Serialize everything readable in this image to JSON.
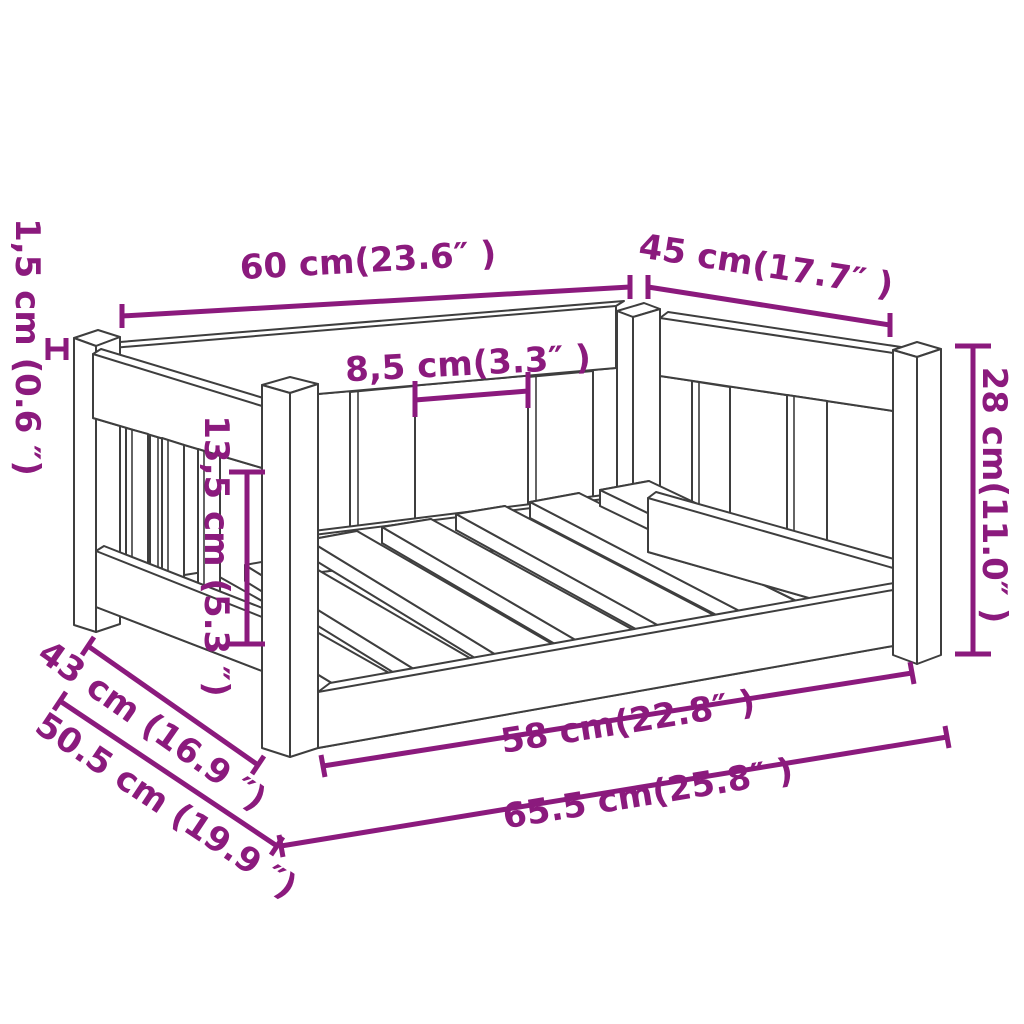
{
  "colors": {
    "dimension_annotation": "#8B1A7D",
    "drawing_line": "#3E3E3E",
    "background": "#FFFFFF"
  },
  "dimensions": {
    "back_width": {
      "cm": "60",
      "inches": "23.6",
      "label": "60 cm(23.6″ )"
    },
    "side_depth": {
      "cm": "45",
      "inches": "17.7",
      "label": "45 cm(17.7″ )"
    },
    "slat_gap": {
      "cm": "8,5",
      "inches": "3.3",
      "label": "8,5 cm(3.3″ )"
    },
    "total_height": {
      "cm": "28",
      "inches": "11.0",
      "label": "28 cm(11.0″ )"
    },
    "board_thickness": {
      "cm": "1,5",
      "inches": "0.6",
      "label": "1,5 cm (0.6 ″)"
    },
    "inner_height": {
      "cm": "13,5",
      "inches": "5.3",
      "label": "13,5 cm (5.3 ″)"
    },
    "inner_depth": {
      "cm": "43",
      "inches": "16.9",
      "label": "43 cm (16.9 ″)"
    },
    "outer_depth": {
      "cm": "50.5",
      "inches": "19.9",
      "label": "50.5 cm (19.9 ″)"
    },
    "inner_width": {
      "cm": "58",
      "inches": "22.8",
      "label": "58 cm(22.8″ )"
    },
    "outer_width": {
      "cm": "65.5",
      "inches": "25.8",
      "label": "65.5 cm(25.8″ )"
    }
  }
}
